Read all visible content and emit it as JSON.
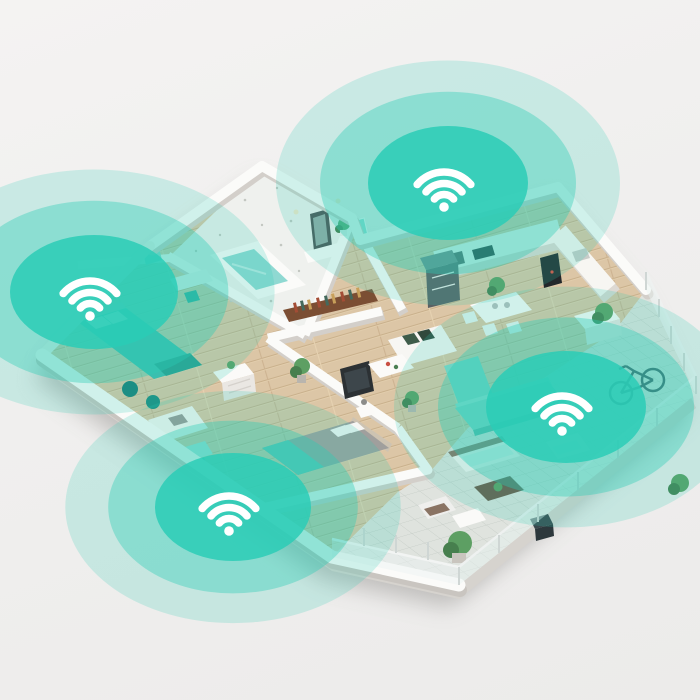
{
  "scene": {
    "type": "isometric-apartment-floorplan-with-mesh-wifi-coverage",
    "background_color": "#f0efee",
    "accent_color": "#2accb6",
    "shadow_color": "#8c8a87",
    "wall_color": "#fbfbf9",
    "wood_floor_color": "#dcc6a6",
    "terrace_tile_color": "#dfe3de",
    "bath_water_color": "#8fd9d2"
  },
  "icon": {
    "glyph": "wifi",
    "color": "#ffffff"
  },
  "rings": {
    "inner_opacity": 0.85,
    "middle_opacity": 0.38,
    "outer_opacity": 0.2,
    "middle_scale": 1.6,
    "outer_scale": 2.15
  },
  "wifi_zones": [
    {
      "name": "wifi-zone-kitchen",
      "cx": 448,
      "cy": 183,
      "rx": 80,
      "ry": 57
    },
    {
      "name": "wifi-zone-bedroom-left",
      "cx": 94,
      "cy": 292,
      "rx": 84,
      "ry": 57
    },
    {
      "name": "wifi-zone-terrace",
      "cx": 566,
      "cy": 407,
      "rx": 80,
      "ry": 56
    },
    {
      "name": "wifi-zone-bedroom-front",
      "cx": 233,
      "cy": 507,
      "rx": 78,
      "ry": 54
    }
  ]
}
